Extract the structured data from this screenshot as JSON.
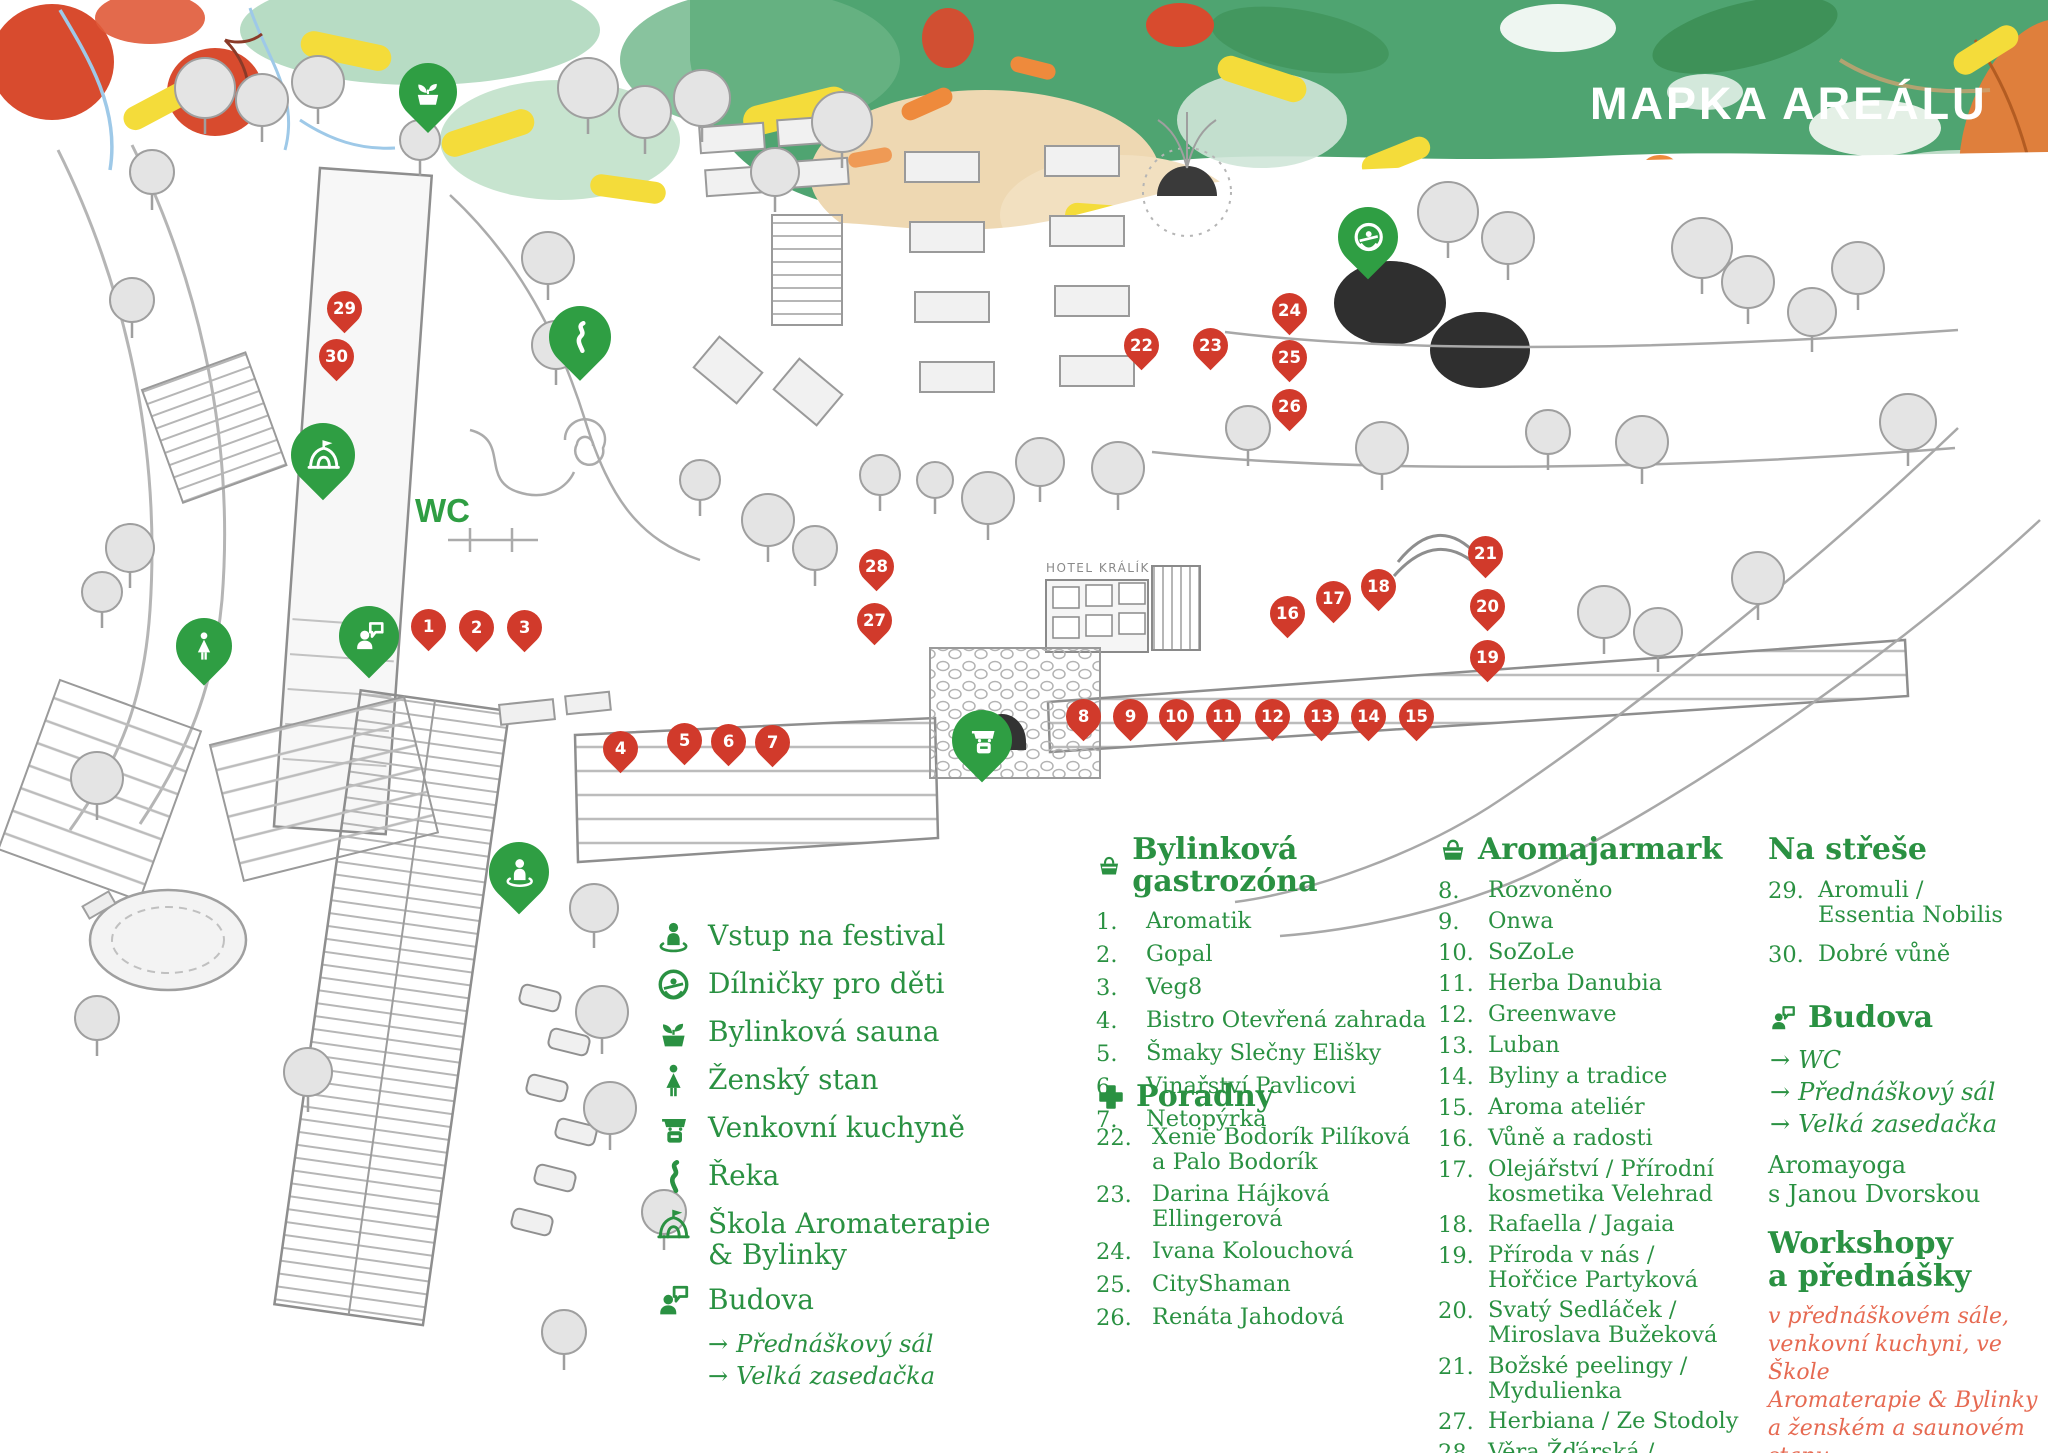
{
  "title": "MAPKA AREÁLU",
  "colors": {
    "green": "#2f9e43",
    "text_green": "#2a9142",
    "red": "#d13a2b",
    "salmon": "#e66a52",
    "band_green": "#4fa471"
  },
  "map": {
    "wc_label": "WC",
    "hotel_label": "HOTEL KRÁLÍK",
    "red_pins": [
      {
        "n": "1",
        "x": 428,
        "y": 626
      },
      {
        "n": "2",
        "x": 476,
        "y": 627
      },
      {
        "n": "3",
        "x": 524,
        "y": 627
      },
      {
        "n": "4",
        "x": 620,
        "y": 748
      },
      {
        "n": "5",
        "x": 684,
        "y": 740
      },
      {
        "n": "6",
        "x": 728,
        "y": 741
      },
      {
        "n": "7",
        "x": 772,
        "y": 742
      },
      {
        "n": "8",
        "x": 1083,
        "y": 716
      },
      {
        "n": "9",
        "x": 1130,
        "y": 716
      },
      {
        "n": "10",
        "x": 1176,
        "y": 716
      },
      {
        "n": "11",
        "x": 1223,
        "y": 716
      },
      {
        "n": "12",
        "x": 1272,
        "y": 716
      },
      {
        "n": "13",
        "x": 1321,
        "y": 716
      },
      {
        "n": "14",
        "x": 1368,
        "y": 716
      },
      {
        "n": "15",
        "x": 1416,
        "y": 716
      },
      {
        "n": "16",
        "x": 1287,
        "y": 613
      },
      {
        "n": "17",
        "x": 1333,
        "y": 598
      },
      {
        "n": "18",
        "x": 1378,
        "y": 586
      },
      {
        "n": "19",
        "x": 1487,
        "y": 657
      },
      {
        "n": "20",
        "x": 1487,
        "y": 606
      },
      {
        "n": "21",
        "x": 1485,
        "y": 553
      },
      {
        "n": "22",
        "x": 1141,
        "y": 345
      },
      {
        "n": "23",
        "x": 1210,
        "y": 345
      },
      {
        "n": "24",
        "x": 1289,
        "y": 310
      },
      {
        "n": "25",
        "x": 1289,
        "y": 357
      },
      {
        "n": "26",
        "x": 1289,
        "y": 406
      },
      {
        "n": "27",
        "x": 874,
        "y": 620
      },
      {
        "n": "28",
        "x": 876,
        "y": 566
      },
      {
        "n": "29",
        "x": 344,
        "y": 308
      },
      {
        "n": "30",
        "x": 336,
        "y": 356
      }
    ],
    "green_pins": [
      {
        "icon": "sauna-icon",
        "x": 428,
        "y": 92,
        "s": 58
      },
      {
        "icon": "river-icon",
        "x": 580,
        "y": 337,
        "s": 62
      },
      {
        "icon": "school-icon",
        "x": 323,
        "y": 455,
        "s": 64
      },
      {
        "icon": "kids-icon",
        "x": 1368,
        "y": 237,
        "s": 60
      },
      {
        "icon": "woman-icon",
        "x": 204,
        "y": 646,
        "s": 56
      },
      {
        "icon": "building-icon",
        "x": 369,
        "y": 636,
        "s": 60
      },
      {
        "icon": "kitchen-icon",
        "x": 982,
        "y": 740,
        "s": 60
      },
      {
        "icon": "entry-icon",
        "x": 519,
        "y": 872,
        "s": 60
      }
    ]
  },
  "legend": {
    "items": [
      {
        "icon": "entry-icon",
        "label": "Vstup na festival"
      },
      {
        "icon": "kids-icon",
        "label": "Dílničky pro děti"
      },
      {
        "icon": "sauna-icon",
        "label": "Bylinková sauna"
      },
      {
        "icon": "woman-icon",
        "label": "Ženský stan"
      },
      {
        "icon": "kitchen-icon",
        "label": "Venkovní kuchyně"
      },
      {
        "icon": "river-icon",
        "label": "Řeka"
      },
      {
        "icon": "school-icon",
        "label": "Škola Aromaterapie\n& Bylinky"
      },
      {
        "icon": "building-icon",
        "label": "Budova",
        "subitems": [
          "Přednáškový sál",
          "Velká zasedačka"
        ]
      }
    ]
  },
  "sections": {
    "gastro": {
      "title": "Bylinková gastrozóna",
      "icon": "basket-icon",
      "items": [
        {
          "num": "1.",
          "name": "Aromatik"
        },
        {
          "num": "2.",
          "name": "Gopal"
        },
        {
          "num": "3.",
          "name": "Veg8"
        },
        {
          "num": "4.",
          "name": "Bistro Otevřená zahrada"
        },
        {
          "num": "5.",
          "name": "Šmaky Slečny Elišky"
        },
        {
          "num": "6.",
          "name": "Vinařství Pavlicovi"
        },
        {
          "num": "7.",
          "name": "Netopýrka"
        }
      ]
    },
    "poradny": {
      "title": "Poradny",
      "icon": "cross-icon",
      "items": [
        {
          "num": "22.",
          "name": "Xenie Bodorík Pilíková\na Palo Bodorík"
        },
        {
          "num": "23.",
          "name": "Darina Hájková Ellingerová"
        },
        {
          "num": "24.",
          "name": "Ivana Kolouchová"
        },
        {
          "num": "25.",
          "name": "CityShaman"
        },
        {
          "num": "26.",
          "name": "Renáta Jahodová"
        }
      ]
    },
    "jarmark": {
      "title": "Aromajarmark",
      "icon": "basket-icon",
      "items": [
        {
          "num": "8.",
          "name": "Rozvoněno"
        },
        {
          "num": "9.",
          "name": "Onwa"
        },
        {
          "num": "10.",
          "name": "SoZoLe"
        },
        {
          "num": "11.",
          "name": "Herba Danubia"
        },
        {
          "num": "12.",
          "name": "Greenwave"
        },
        {
          "num": "13.",
          "name": "Luban"
        },
        {
          "num": "14.",
          "name": "Byliny a tradice"
        },
        {
          "num": "15.",
          "name": "Aroma ateliér"
        },
        {
          "num": "16.",
          "name": "Vůně a radosti"
        },
        {
          "num": "17.",
          "name": "Olejářství / Přírodní\nkosmetika Velehrad"
        },
        {
          "num": "18.",
          "name": "Rafaella / Jagaia"
        },
        {
          "num": "19.",
          "name": "Příroda v nás /\nHořčice Partyková"
        },
        {
          "num": "20.",
          "name": "Svatý Sedláček /\nMiroslava Bužeková"
        },
        {
          "num": "21.",
          "name": "Božské peelingy /\nMydulienka"
        },
        {
          "num": "27.",
          "name": "Herbiana / Ze Stodoly"
        },
        {
          "num": "28.",
          "name": "Věra Žďárská /  Květomluva"
        }
      ]
    },
    "roof": {
      "title": "Na střeše",
      "items": [
        {
          "num": "29.",
          "name": "Aromuli /\nEssentia Nobilis"
        },
        {
          "num": "30.",
          "name": "Dobré vůně"
        }
      ]
    },
    "budova": {
      "title": "Budova",
      "icon": "building-icon",
      "arrows": [
        "WC",
        "Přednáškový sál",
        "Velká zasedačka"
      ],
      "extra": "Aromayoga\ns Janou Dvorskou"
    },
    "workshops": {
      "title": "Workshopy\na přednášky",
      "note": "v přednáškovém sále,\nvenkovní kuchyni, ve Škole\nAromaterapie & Bylinky\na ženském a saunovém stanu"
    }
  }
}
